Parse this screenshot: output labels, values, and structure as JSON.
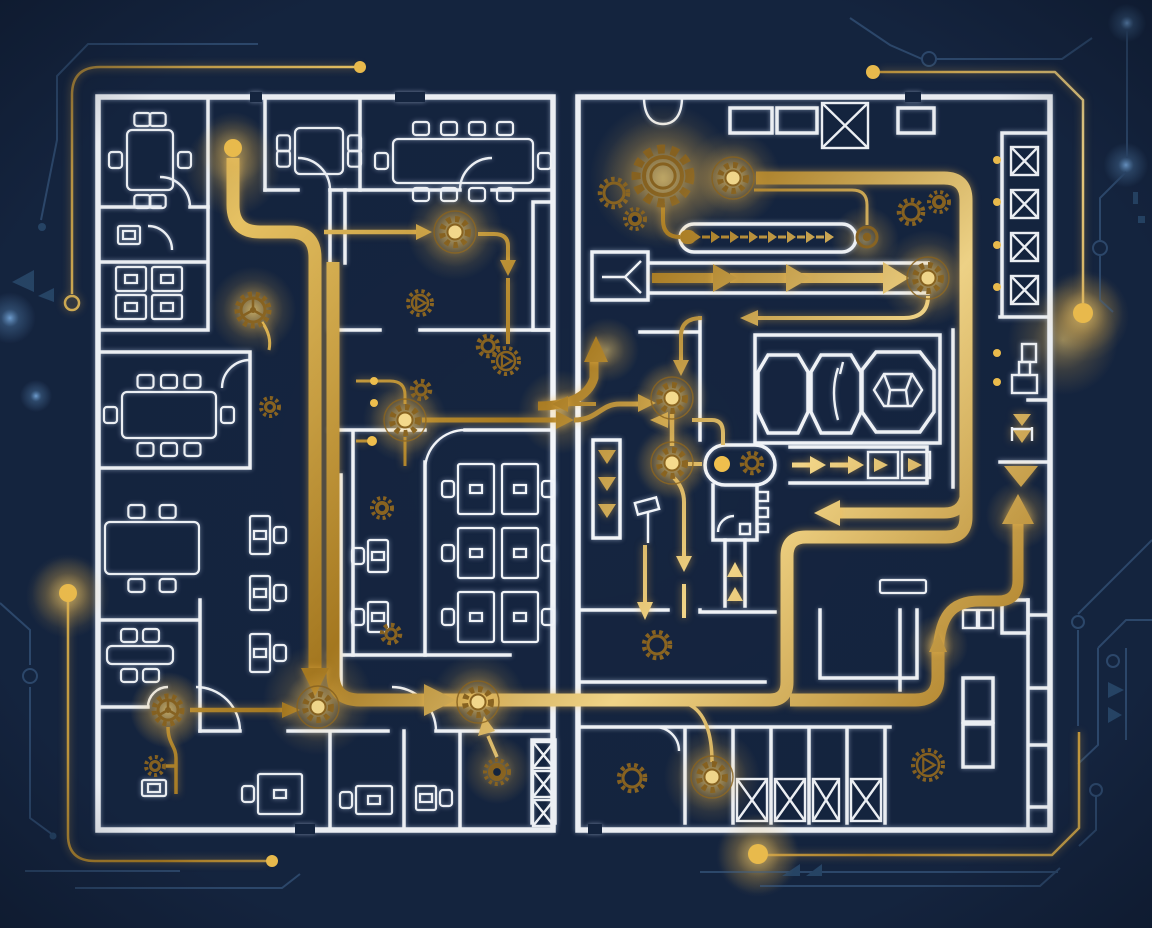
{
  "scene": {
    "title": "automation-blueprint-floorplan",
    "description": "dark navy architectural floor plan with gold circuit flow paths, gears and arrows"
  },
  "palette": {
    "navy": "#152540",
    "navy_deep": "#0f1c33",
    "wall": "#f4f7fb",
    "gold": "#d9a93f",
    "gold_light": "#f6d98a",
    "gold_dark": "#8a6420",
    "glow": "#ffd977",
    "blue_trace": "#2e4a6e",
    "blue_trace_fill": "#274668",
    "blue_dot": "#6f9fd0"
  },
  "gears": [
    {
      "x": 663,
      "y": 176,
      "r": 27,
      "style": "big",
      "glow": true
    },
    {
      "x": 614,
      "y": 193,
      "r": 14,
      "style": "ring"
    },
    {
      "x": 635,
      "y": 219,
      "r": 10,
      "style": "solid"
    },
    {
      "x": 911,
      "y": 212,
      "r": 12,
      "style": "ring"
    },
    {
      "x": 939,
      "y": 202,
      "r": 10,
      "style": "solid"
    },
    {
      "x": 733,
      "y": 178,
      "r": 13,
      "style": "node",
      "glow": true
    },
    {
      "x": 928,
      "y": 278,
      "r": 13,
      "style": "node",
      "glow": true
    },
    {
      "x": 867,
      "y": 237,
      "r": 10,
      "style": "port"
    },
    {
      "x": 672,
      "y": 398,
      "r": 13,
      "style": "node",
      "glow": true
    },
    {
      "x": 672,
      "y": 463,
      "r": 13,
      "style": "node",
      "glow": true
    },
    {
      "x": 752,
      "y": 463,
      "r": 10,
      "style": "ring"
    },
    {
      "x": 455,
      "y": 232,
      "r": 13,
      "style": "node",
      "glow": true
    },
    {
      "x": 405,
      "y": 420,
      "r": 13,
      "style": "node",
      "glow": true
    },
    {
      "x": 421,
      "y": 390,
      "r": 9,
      "style": "ring"
    },
    {
      "x": 420,
      "y": 303,
      "r": 12,
      "style": "triangle"
    },
    {
      "x": 253,
      "y": 310,
      "r": 16,
      "style": "spoke",
      "glow": true
    },
    {
      "x": 270,
      "y": 407,
      "r": 9,
      "style": "solid"
    },
    {
      "x": 382,
      "y": 508,
      "r": 10,
      "style": "solid"
    },
    {
      "x": 391,
      "y": 634,
      "r": 9,
      "style": "ring"
    },
    {
      "x": 488,
      "y": 346,
      "r": 10,
      "style": "ring"
    },
    {
      "x": 506,
      "y": 361,
      "r": 13,
      "style": "triangle"
    },
    {
      "x": 168,
      "y": 710,
      "r": 14,
      "style": "spoke",
      "glow": true
    },
    {
      "x": 155,
      "y": 766,
      "r": 9,
      "style": "solid"
    },
    {
      "x": 318,
      "y": 707,
      "r": 13,
      "style": "node",
      "glow": true
    },
    {
      "x": 478,
      "y": 702,
      "r": 13,
      "style": "node",
      "glow": true
    },
    {
      "x": 497,
      "y": 772,
      "r": 12,
      "style": "solid"
    },
    {
      "x": 712,
      "y": 777,
      "r": 13,
      "style": "node",
      "glow": true
    },
    {
      "x": 632,
      "y": 778,
      "r": 13,
      "style": "ring"
    },
    {
      "x": 657,
      "y": 645,
      "r": 13,
      "style": "ring"
    },
    {
      "x": 928,
      "y": 765,
      "r": 15,
      "style": "triangle"
    }
  ],
  "gold_dots": [
    {
      "x": 233,
      "y": 148,
      "r": 9,
      "glow": true
    },
    {
      "x": 68,
      "y": 593,
      "r": 9,
      "glow": true
    },
    {
      "x": 1083,
      "y": 313,
      "r": 10,
      "glow": true
    },
    {
      "x": 758,
      "y": 854,
      "r": 10,
      "glow": true
    },
    {
      "x": 873,
      "y": 72,
      "r": 7
    },
    {
      "x": 360,
      "y": 67,
      "r": 6
    },
    {
      "x": 272,
      "y": 861,
      "r": 6
    },
    {
      "x": 372,
      "y": 441,
      "r": 5
    },
    {
      "x": 374,
      "y": 381,
      "r": 4
    },
    {
      "x": 374,
      "y": 403,
      "r": 4
    },
    {
      "x": 722,
      "y": 464,
      "r": 8
    },
    {
      "x": 997,
      "y": 160,
      "r": 4
    },
    {
      "x": 997,
      "y": 202,
      "r": 4
    },
    {
      "x": 997,
      "y": 245,
      "r": 4
    },
    {
      "x": 997,
      "y": 287,
      "r": 4
    },
    {
      "x": 997,
      "y": 353,
      "r": 4
    },
    {
      "x": 997,
      "y": 382,
      "r": 4
    }
  ],
  "glows": [
    {
      "x": 233,
      "y": 168,
      "r": 48
    },
    {
      "x": 455,
      "y": 232,
      "r": 48
    },
    {
      "x": 405,
      "y": 420,
      "r": 42
    },
    {
      "x": 672,
      "y": 398,
      "r": 38
    },
    {
      "x": 672,
      "y": 463,
      "r": 38
    },
    {
      "x": 318,
      "y": 700,
      "r": 55
    },
    {
      "x": 478,
      "y": 702,
      "r": 48
    },
    {
      "x": 712,
      "y": 777,
      "r": 48
    },
    {
      "x": 733,
      "y": 178,
      "r": 48
    },
    {
      "x": 928,
      "y": 278,
      "r": 48
    },
    {
      "x": 663,
      "y": 180,
      "r": 62
    },
    {
      "x": 1083,
      "y": 316,
      "r": 46
    },
    {
      "x": 68,
      "y": 596,
      "r": 42
    },
    {
      "x": 758,
      "y": 855,
      "r": 42
    },
    {
      "x": 168,
      "y": 710,
      "r": 38
    },
    {
      "x": 938,
      "y": 645,
      "r": 30
    },
    {
      "x": 1020,
      "y": 515,
      "r": 34
    },
    {
      "x": 607,
      "y": 350,
      "r": 32
    },
    {
      "x": 560,
      "y": 412,
      "r": 42
    },
    {
      "x": 253,
      "y": 310,
      "r": 30
    },
    {
      "x": 1063,
      "y": 340,
      "r": 55
    },
    {
      "x": 865,
      "y": 240,
      "r": 34
    },
    {
      "x": 497,
      "y": 770,
      "r": 34
    }
  ],
  "bokeh": [
    {
      "x": 10,
      "y": 318,
      "r": 8
    },
    {
      "x": 36,
      "y": 396,
      "r": 5
    },
    {
      "x": 1127,
      "y": 23,
      "r": 6
    },
    {
      "x": 1126,
      "y": 165,
      "r": 7
    }
  ],
  "x_boxes": [
    {
      "x": 822,
      "y": 103,
      "w": 46,
      "h": 45
    },
    {
      "x": 1011,
      "y": 147,
      "w": 27,
      "h": 28
    },
    {
      "x": 1011,
      "y": 190,
      "w": 27,
      "h": 28
    },
    {
      "x": 1011,
      "y": 233,
      "w": 27,
      "h": 28
    },
    {
      "x": 1011,
      "y": 276,
      "w": 27,
      "h": 28
    },
    {
      "x": 737,
      "y": 779,
      "w": 30,
      "h": 42
    },
    {
      "x": 775,
      "y": 779,
      "w": 30,
      "h": 42
    },
    {
      "x": 813,
      "y": 779,
      "w": 26,
      "h": 42
    },
    {
      "x": 851,
      "y": 779,
      "w": 30,
      "h": 42
    },
    {
      "x": 533,
      "y": 742,
      "w": 21,
      "h": 26
    },
    {
      "x": 533,
      "y": 771,
      "w": 21,
      "h": 26
    },
    {
      "x": 533,
      "y": 800,
      "w": 21,
      "h": 26
    }
  ],
  "tables": [
    {
      "x": 127,
      "y": 130,
      "w": 46,
      "h": 60,
      "top": 2,
      "bottom": 2,
      "left": 1,
      "right": 1
    },
    {
      "x": 295,
      "y": 128,
      "w": 48,
      "h": 46,
      "top": 0,
      "bottom": 0,
      "left": 2,
      "right": 2
    },
    {
      "x": 393,
      "y": 139,
      "w": 140,
      "h": 44,
      "top": 4,
      "bottom": 4,
      "left": 1,
      "right": 1
    },
    {
      "x": 122,
      "y": 392,
      "w": 94,
      "h": 46,
      "top": 3,
      "bottom": 3,
      "left": 1,
      "right": 1
    },
    {
      "x": 107,
      "y": 646,
      "w": 66,
      "h": 18,
      "top": 2,
      "bottom": 2,
      "left": 0,
      "right": 0
    },
    {
      "x": 105,
      "y": 522,
      "w": 94,
      "h": 52,
      "top": 2,
      "bottom": 2,
      "left": 0,
      "right": 0
    }
  ],
  "desks": [
    {
      "x": 118,
      "y": 226,
      "w": 22,
      "h": 18
    },
    {
      "x": 116,
      "y": 267,
      "w": 30,
      "h": 24
    },
    {
      "x": 152,
      "y": 267,
      "w": 30,
      "h": 24
    },
    {
      "x": 116,
      "y": 295,
      "w": 30,
      "h": 24
    },
    {
      "x": 152,
      "y": 295,
      "w": 30,
      "h": 24
    },
    {
      "x": 250,
      "y": 516,
      "w": 20,
      "h": 38,
      "chair": "right"
    },
    {
      "x": 250,
      "y": 576,
      "w": 20,
      "h": 34,
      "chair": "right"
    },
    {
      "x": 250,
      "y": 634,
      "w": 20,
      "h": 38,
      "chair": "right"
    },
    {
      "x": 458,
      "y": 464,
      "w": 36,
      "h": 50,
      "chair": "left"
    },
    {
      "x": 458,
      "y": 528,
      "w": 36,
      "h": 50,
      "chair": "left"
    },
    {
      "x": 458,
      "y": 592,
      "w": 36,
      "h": 50,
      "chair": "left"
    },
    {
      "x": 502,
      "y": 464,
      "w": 36,
      "h": 50,
      "chair": "right"
    },
    {
      "x": 502,
      "y": 528,
      "w": 36,
      "h": 50,
      "chair": "right"
    },
    {
      "x": 502,
      "y": 592,
      "w": 36,
      "h": 50,
      "chair": "right"
    },
    {
      "x": 368,
      "y": 540,
      "w": 20,
      "h": 32,
      "chair": "left"
    },
    {
      "x": 368,
      "y": 602,
      "w": 20,
      "h": 30,
      "chair": "left"
    },
    {
      "x": 258,
      "y": 774,
      "w": 44,
      "h": 40,
      "chair": "left"
    },
    {
      "x": 356,
      "y": 786,
      "w": 36,
      "h": 28,
      "chair": "left"
    },
    {
      "x": 416,
      "y": 786,
      "w": 20,
      "h": 24,
      "chair": "right"
    },
    {
      "x": 142,
      "y": 780,
      "w": 24,
      "h": 16
    },
    {
      "x": 880,
      "y": 580,
      "w": 46,
      "h": 13
    }
  ],
  "dash_arrow_row": {
    "x0": 692,
    "y": 237,
    "count": 8,
    "step": 19
  }
}
